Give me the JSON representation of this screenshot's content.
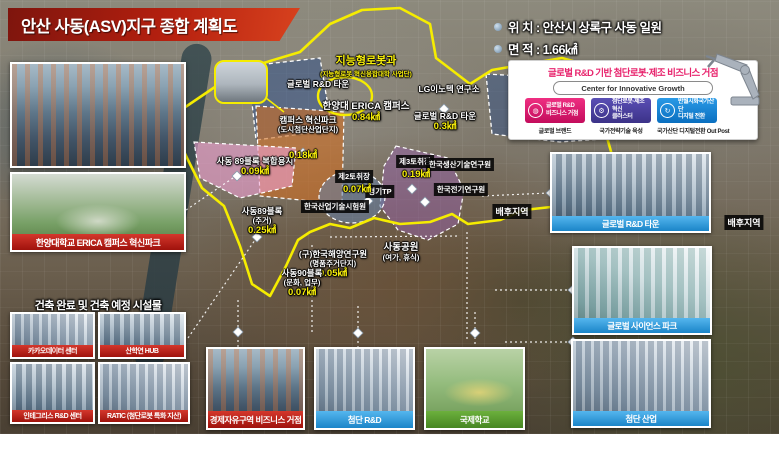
{
  "title": "안산 사동(ASV)지구 종합 계획도",
  "location": {
    "line1": "위 치 : 안산시 상록구 사동 일원",
    "line2": "면 적 : 1.66㎢"
  },
  "info_card": {
    "title": "글로벌 R&D 기반 첨단로봇·제조 비즈니스 거점",
    "badge": "Center for Innovative Growth",
    "items": [
      {
        "label1": "글로벌 R&D",
        "label2": "비즈니스 거점",
        "sub": "글로벌 브랜드",
        "color": "#e0146e"
      },
      {
        "label1": "첨단로봇·제조혁신",
        "label2": "클러스터",
        "sub": "국가전략기술 육성",
        "color": "#4a3f9f"
      },
      {
        "label1": "반월시화국가산단",
        "label2": "디지털 전환",
        "sub": "국가산단 디지털전환 Out Post",
        "color": "#0d8bd9"
      }
    ]
  },
  "map": {
    "robot_dept": {
      "text": "지능형로봇과",
      "sub": "(지능형로봇 혁신융합대학 사업단)"
    },
    "global_rd_town_nw": {
      "text": "글로벌 R&D 타운"
    },
    "lg_innotek": {
      "text": "LG이노텍 연구소"
    },
    "erica_campus": {
      "text": "한양대 ERICA 캠퍼스",
      "area": "0.84㎢"
    },
    "campus_park": {
      "text": "캠퍼스 혁신파크",
      "sub": "(도시첨단산업단지)",
      "area": "0.18㎢"
    },
    "global_rd_town_e": {
      "text": "글로벌 R&D 타운",
      "area": "0.3㎢"
    },
    "block89_mixed": {
      "text": "사동 89블록 복합용지",
      "area": "0.09㎢"
    },
    "pit2": {
      "text": "제2토취장",
      "area": "0.07㎢"
    },
    "pit3": {
      "text": "제3토취장",
      "area": "0.19㎢"
    },
    "gyeonggi_tp": {
      "text": "경기TP"
    },
    "kitech": {
      "text": "한국생산기술연구원"
    },
    "keri": {
      "text": "한국전기연구원"
    },
    "ktl": {
      "text": "한국산업기술시험원"
    },
    "block89_res": {
      "text": "사동89블록",
      "sub": "(주거)",
      "area": "0.25㎢"
    },
    "kordi": {
      "text": "(구)한국해양연구원",
      "sub": "(명품주거단지)",
      "area": "0.05㎢"
    },
    "block90": {
      "text": "사동90블록",
      "sub": "(문화, 업무)",
      "area": "0.07㎢"
    },
    "sadong_park": {
      "text": "사동공원",
      "sub": "(여가, 휴식)"
    },
    "hinterland_mid": {
      "text": "배후지역"
    },
    "hinterland_right": {
      "text": "배후지역"
    }
  },
  "left_panel": {
    "campus_caption": "한양대학교 ERICA 캠퍼스 혁신파크",
    "section_title": "건축 완료 및 건축 예정 시설물",
    "facilities": [
      {
        "caption": "카카오데이터 센터"
      },
      {
        "caption": "산학연 HUB"
      },
      {
        "caption": "인테그리스 R&D 센터"
      },
      {
        "caption": "RATIC (첨단로봇 특화 지산)"
      }
    ]
  },
  "bottom_photos": [
    {
      "caption": "경제자유구역 비즈니스 거점"
    },
    {
      "caption": "첨단 R&D"
    },
    {
      "caption": "국제학교"
    }
  ],
  "right_photos": [
    {
      "caption": "글로벌 R&D 타운"
    },
    {
      "caption": "글로벌 사이언스 파크"
    },
    {
      "caption": "첨단 산업"
    }
  ],
  "colors": {
    "boundary_yellow": "#f5ec00",
    "caption_red": "#c01e1e",
    "caption_blue": "#2596d8",
    "caption_green": "#56a02e",
    "banner_red": "#b5200f",
    "accent_pink": "#e8246d"
  }
}
